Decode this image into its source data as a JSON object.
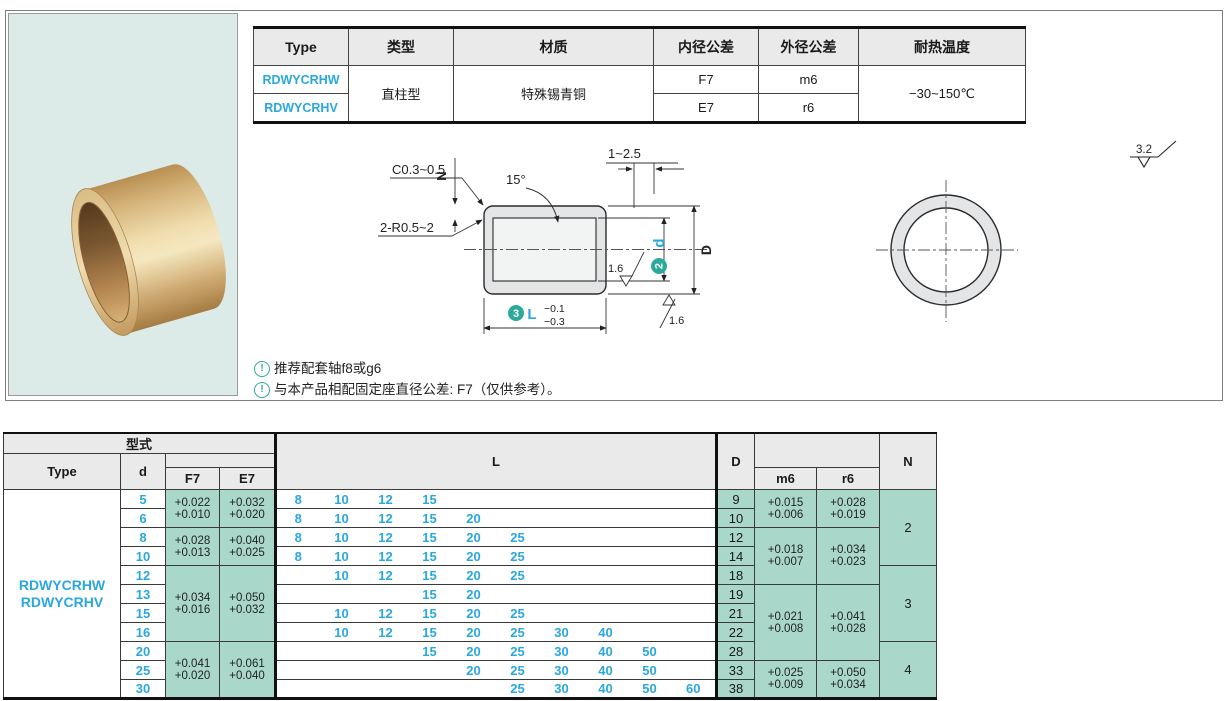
{
  "colors": {
    "accent_cyan": "#29a8e0",
    "accent_teal": "#2ba99b",
    "cell_teal": "#a9d7c9",
    "header_gray": "#eaeaea",
    "photo_background": "#dcebe8"
  },
  "spec_table": {
    "headers": [
      "Type",
      "类型",
      "材质",
      "内径公差",
      "外径公差",
      "耐热温度"
    ],
    "type_codes": [
      "RDWYCRHW",
      "RDWYCRHV"
    ],
    "category": "直柱型",
    "material": "特殊锡青铜",
    "inner_tolerances": [
      "F7",
      "E7"
    ],
    "outer_tolerances": [
      "m6",
      "r6"
    ],
    "heat_resistance": "−30~150℃"
  },
  "drawing": {
    "chamfer": "C0.3~0.5",
    "corner_radius": "2-R0.5~2",
    "angle": "15°",
    "end_length": "1~2.5",
    "wall": "N",
    "outer_dia": "D",
    "inner_dia": "d",
    "length": "L",
    "balloon_d": "2",
    "balloon_l": "3",
    "len_tol_upper": "−0.1",
    "len_tol_lower": "−0.3",
    "roughness_bore": "1.6",
    "roughness_outer": "1.6",
    "roughness_general": "3.2"
  },
  "notes": [
    "推荐配套轴f8或g6",
    "与本产品相配固定座直径公差: F7（仅供参考）。"
  ],
  "size_table": {
    "header": {
      "model": "型式",
      "type": "Type",
      "d": "d",
      "f7": "F7",
      "e7": "E7",
      "l": "L",
      "big_d": "D",
      "m6": "m6",
      "r6": "r6",
      "n": "N"
    },
    "type_codes": [
      "RDWYCRHW",
      "RDWYCRHV"
    ],
    "length_columns": [
      8,
      10,
      12,
      15,
      20,
      25,
      30,
      40,
      50,
      60
    ],
    "rows": [
      {
        "d": 5,
        "D": 9,
        "lengths": [
          8,
          10,
          12,
          15
        ]
      },
      {
        "d": 6,
        "D": 10,
        "lengths": [
          8,
          10,
          12,
          15,
          20
        ]
      },
      {
        "d": 8,
        "D": 12,
        "lengths": [
          8,
          10,
          12,
          15,
          20,
          25
        ]
      },
      {
        "d": 10,
        "D": 14,
        "lengths": [
          8,
          10,
          12,
          15,
          20,
          25
        ]
      },
      {
        "d": 12,
        "D": 18,
        "lengths": [
          10,
          12,
          15,
          20,
          25
        ]
      },
      {
        "d": 13,
        "D": 19,
        "lengths": [
          15,
          20
        ]
      },
      {
        "d": 15,
        "D": 21,
        "lengths": [
          10,
          12,
          15,
          20,
          25
        ]
      },
      {
        "d": 16,
        "D": 22,
        "lengths": [
          10,
          12,
          15,
          20,
          25,
          30,
          40
        ]
      },
      {
        "d": 20,
        "D": 28,
        "lengths": [
          15,
          20,
          25,
          30,
          40,
          50
        ]
      },
      {
        "d": 25,
        "D": 33,
        "lengths": [
          20,
          25,
          30,
          40,
          50
        ]
      },
      {
        "d": 30,
        "D": 38,
        "lengths": [
          25,
          30,
          40,
          50,
          60
        ]
      }
    ],
    "f7e7_groups": [
      {
        "start": 0,
        "span": 2,
        "f7": [
          "+0.022",
          "+0.010"
        ],
        "e7": [
          "+0.032",
          "+0.020"
        ]
      },
      {
        "start": 2,
        "span": 2,
        "f7": [
          "+0.028",
          "+0.013"
        ],
        "e7": [
          "+0.040",
          "+0.025"
        ]
      },
      {
        "start": 4,
        "span": 4,
        "f7": [
          "+0.034",
          "+0.016"
        ],
        "e7": [
          "+0.050",
          "+0.032"
        ]
      },
      {
        "start": 8,
        "span": 3,
        "f7": [
          "+0.041",
          "+0.020"
        ],
        "e7": [
          "+0.061",
          "+0.040"
        ]
      }
    ],
    "m6r6_groups": [
      {
        "start": 0,
        "span": 2,
        "m6": [
          "+0.015",
          "+0.006"
        ],
        "r6": [
          "+0.028",
          "+0.019"
        ]
      },
      {
        "start": 2,
        "span": 3,
        "m6": [
          "+0.018",
          "+0.007"
        ],
        "r6": [
          "+0.034",
          "+0.023"
        ]
      },
      {
        "start": 5,
        "span": 4,
        "m6": [
          "+0.021",
          "+0.008"
        ],
        "r6": [
          "+0.041",
          "+0.028"
        ]
      },
      {
        "start": 9,
        "span": 2,
        "m6": [
          "+0.025",
          "+0.009"
        ],
        "r6": [
          "+0.050",
          "+0.034"
        ]
      }
    ],
    "n_groups": [
      {
        "start": 0,
        "span": 4,
        "value": "2"
      },
      {
        "start": 4,
        "span": 4,
        "value": "3"
      },
      {
        "start": 8,
        "span": 3,
        "value": "4"
      }
    ]
  }
}
